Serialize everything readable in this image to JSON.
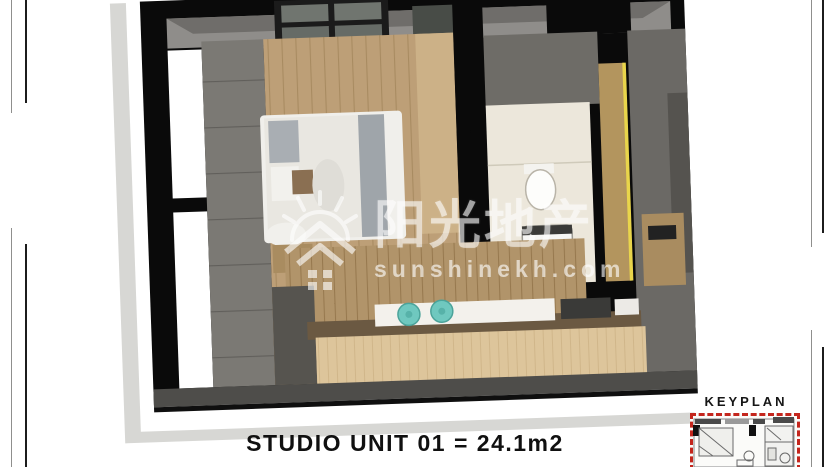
{
  "page": {
    "background": "#ffffff"
  },
  "caption": {
    "text": "STUDIO UNIT 01 = 24.1m2"
  },
  "keyplan": {
    "label": "KEYPLAN",
    "border_color": "#c4261d"
  },
  "watermark": {
    "cn": "阳光地产",
    "url": "sunshinekh.com",
    "color": "#ffffff",
    "logo": "sun-over-house"
  },
  "render": {
    "subject": "studio-unit-3d-top-down-view",
    "colors": {
      "outer_wall_black": "#0a0a0a",
      "wall_gray": "#7b7974",
      "ceiling_gray": "#8f8d8a",
      "floor_wood": "#bd9f77",
      "kitchen_wall_wood": "#b1946a",
      "island_wood": "#ddc59b",
      "island_top_dark": "#6b5942",
      "marble_counter": "#f3f1ec",
      "stool_teal": "#6fc8bf",
      "bath_floor": "#ece7db",
      "door_edge_yellow": "#e9d54b",
      "bed_white": "#e9e7e1",
      "blanket_gray": "#9fa5aa",
      "card_shadow": "#d7d7d4"
    }
  }
}
